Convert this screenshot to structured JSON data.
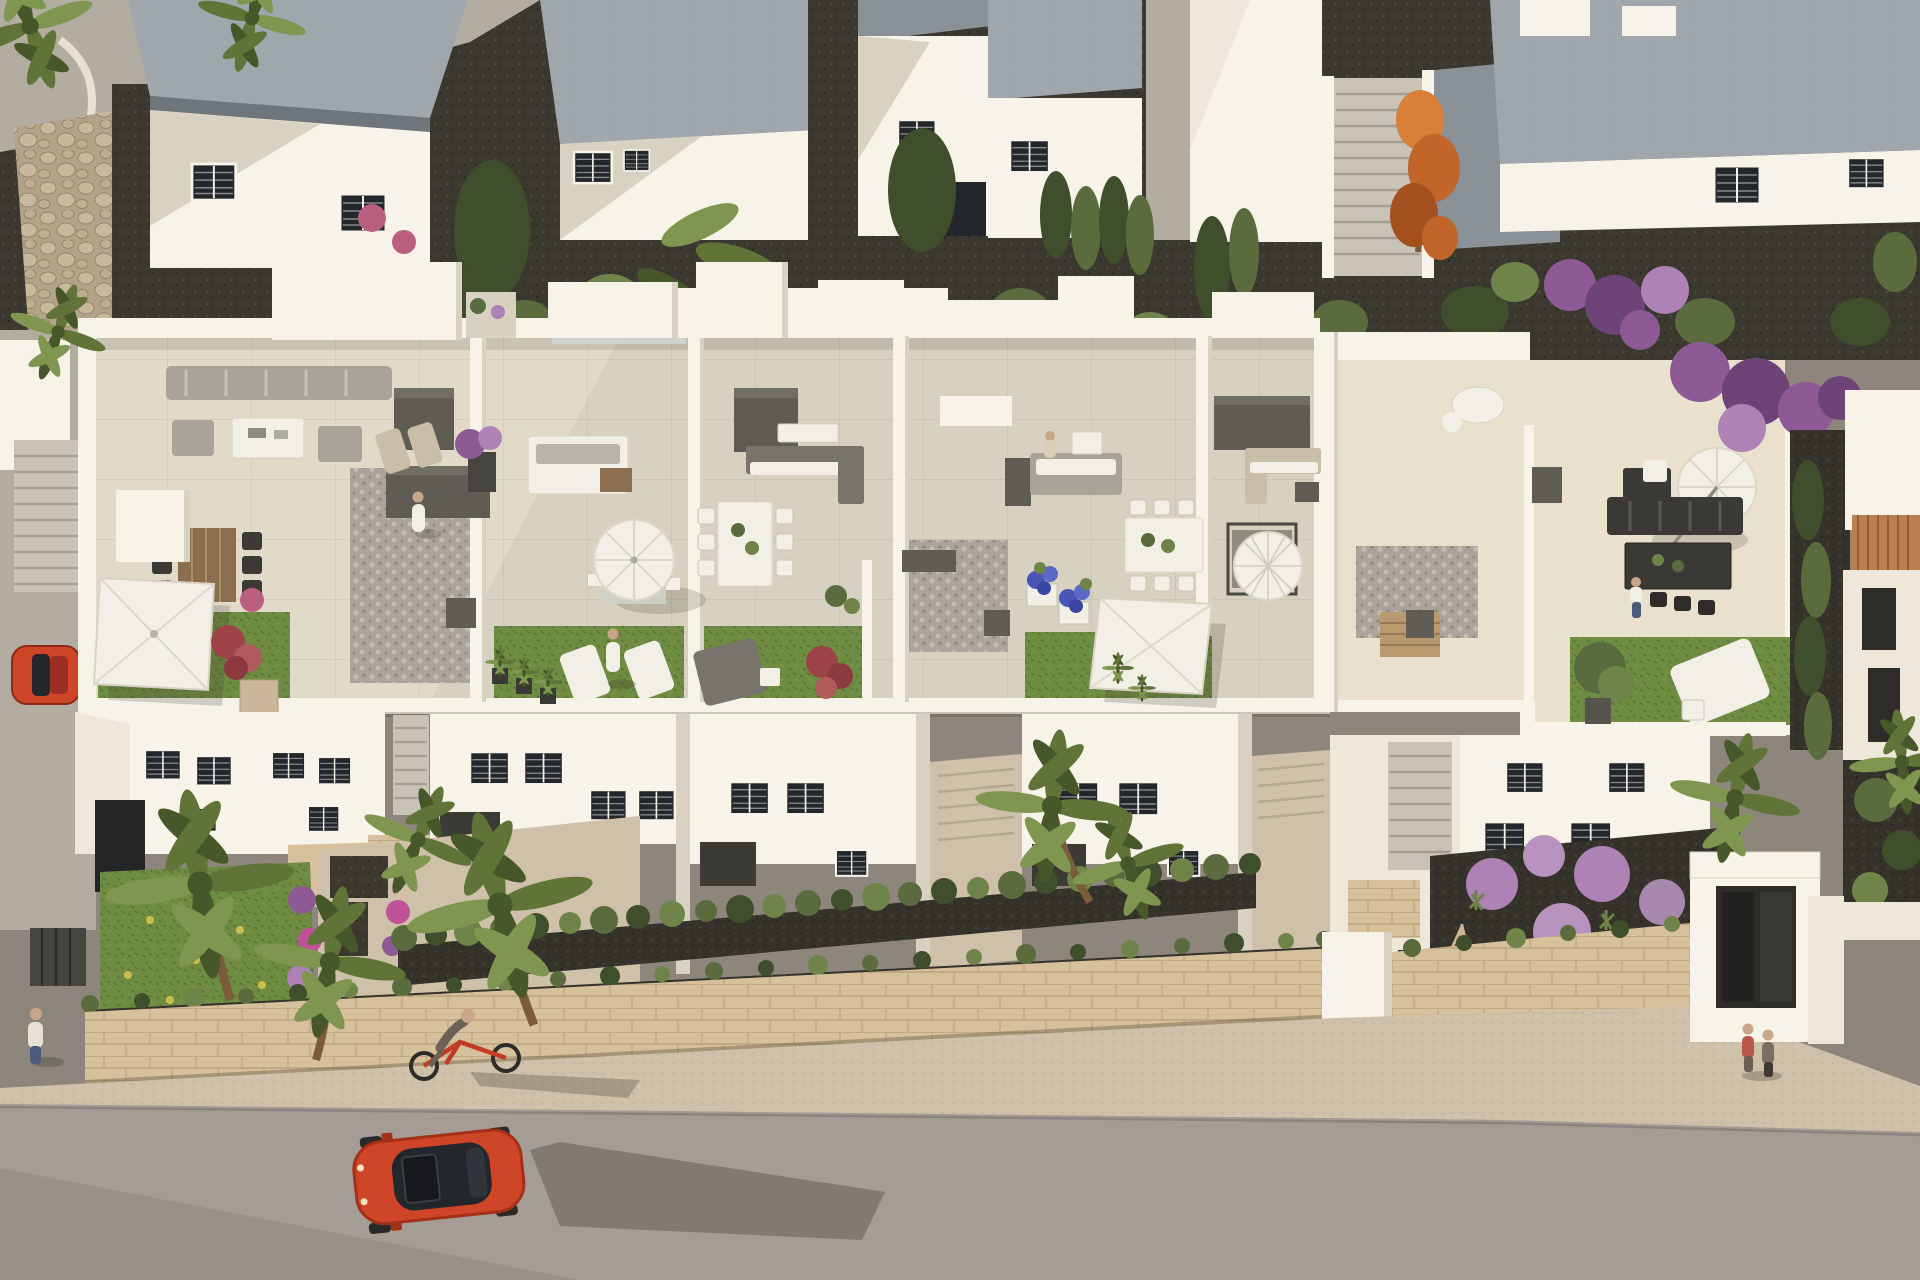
{
  "scene": {
    "description": "Aerial 3D architectural rendering of a white Mediterranean townhouse development with rooftop terraces, gardens, hedges, palm trees, a stone street wall, and a red car on the street below",
    "labels": {
      "background_houses": "row of white villas with grey flat roofs",
      "main_building": "long white townhouse block with five rooftop terraces",
      "right_wing": "right terrace wing with black outdoor furniture",
      "terrace_1": "terrace with grey sofa, wooden dining table, square parasol and lawn",
      "terrace_2": "terrace with white sofa, round parasol and two sun loungers on lawn",
      "terrace_3": "terrace with white dining table and double lounger on lawn",
      "terrace_4": "terrace with grey sofa, white dining table, blue flower planters and square parasol",
      "terrace_5": "terrace with tan corner sofa and ribbed parasol",
      "street": "asphalt street with red car, cyclist and pedestrians",
      "stone_wall": "beige stone retaining wall with hedge",
      "red_car": "red coupe car driving on the street",
      "red_hatchback": "small red hatchback parked at left",
      "bicycle": "cyclist riding a red bicycle",
      "palms": "tall palm trees in front gardens",
      "orange_tree": "orange autumn tree between background houses",
      "lilac_garden": "garden with lilac ball-shaped shrubs"
    },
    "counts": {
      "terrace_units": 5,
      "background_houses": 6,
      "parasols": 6,
      "people": 8,
      "vehicles": 2,
      "palm_trees": 9
    }
  },
  "palette": {
    "gravel": "#3b382f",
    "gravelDot": "#4c483c",
    "path": "#b3aca0",
    "pathShade": "#9a948a",
    "rubble": "#b2a389",
    "rubbleStone": "#c9b99c",
    "rubbleLine": "#94866c",
    "roof": "#a0a7ac",
    "roofShade": "#8a9197",
    "roofEdge": "#6e757b",
    "white": "#f7f3e9",
    "whiteMid": "#efe8da",
    "whiteShade": "#d9d1c2",
    "deepShade": "#b9afa0",
    "floor": "#d8d0c0",
    "floorSun": "#e9e1ce",
    "pebble": "#aba49a",
    "pebbleDot": "#c2bcb2",
    "pebbleDark": "#8f897f",
    "grass": "#6e8c42",
    "grassDark": "#597432",
    "grassLight": "#819c50",
    "hedge": "#5a6c3d",
    "hedgeDark": "#3f4e2b",
    "hedgeLight": "#6f8449",
    "palmTrunk": "#7a5c3a",
    "palm": "#5f7436",
    "palmLight": "#7f9650",
    "palmDark": "#46582a",
    "stone": "#d6c19c",
    "stoneLine": "#bca47d",
    "stoneShade": "#c2ab84",
    "sidewalk": "#cfc1a9",
    "sidewalkDot": "#bdaf96",
    "asphalt": "#a59c96",
    "asphaltDark": "#98908a",
    "soil": "#35322b",
    "carRed": "#cf4527",
    "carRedDark": "#a33118",
    "glass": "#23262b",
    "glassFrame": "#878b8e",
    "bikeRed": "#c33b25",
    "orange": "#c1652a",
    "orangeLight": "#d87f38",
    "orangeDark": "#a4511f",
    "purple": "#8e5a96",
    "purpleLight": "#ae82b5",
    "purpleDark": "#6e4478",
    "blue": "#4956b8",
    "pink": "#bb5f7e",
    "redBush": "#9e4348",
    "wood": "#8a6e4d",
    "woodLight": "#b89a6e",
    "tan": "#c9bfa8",
    "darkBox": "#5f5c55",
    "darkBoxTop": "#716e66",
    "furnGray": "#a9a49a",
    "furnDarkGray": "#77746c",
    "furnWhite": "#f2efe6",
    "furnBlack": "#3b3936",
    "skin": "#c9a687",
    "denim": "#4a5a78",
    "tile": "#b97f4e",
    "tileLine": "#8f5e38",
    "shadow": "rgba(58,50,38,0.28)",
    "shadowSoft": "rgba(58,50,38,0.18)"
  }
}
